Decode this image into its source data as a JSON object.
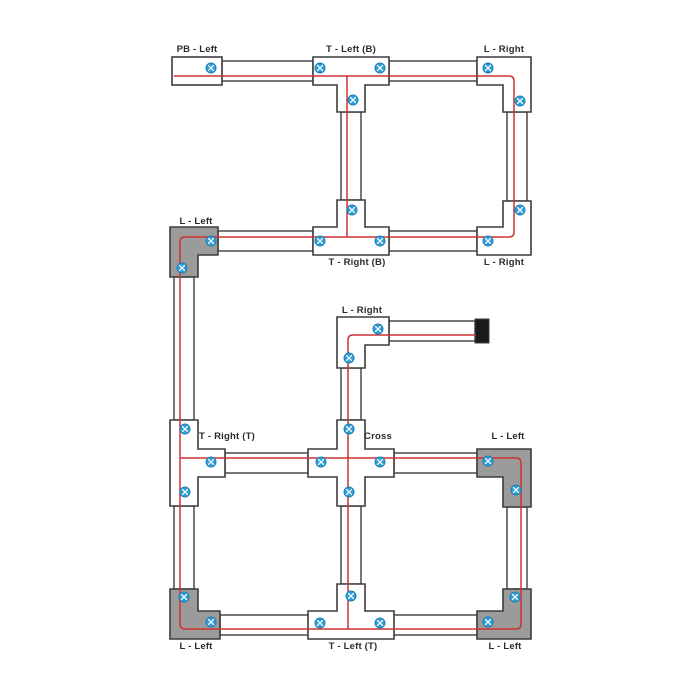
{
  "diagram": {
    "labels": {
      "pb_left": "PB - Left",
      "t_left_b": "T - Left (B)",
      "l_right_top": "L - Right",
      "l_left_mid": "L - Left",
      "t_right_b": "T - Right (B)",
      "l_right_mid": "L - Right",
      "l_right_feed": "L - Right",
      "t_right_t": "T - Right (T)",
      "cross": "Cross",
      "l_left_right": "L - Left",
      "l_left_bottom_left": "L - Left",
      "t_left_t": "T - Left (T)",
      "l_left_bottom_right": "L - Left"
    },
    "colors": {
      "background": "#ffffff",
      "track_outline": "#3d3d3d",
      "conductor_red": "#cc3333",
      "screw_blue": "#2e9fd8",
      "connector_gray": "#9b9b9b",
      "end_cap_black": "#1a1a1a",
      "label_color": "#2b2b2b"
    },
    "icons": {
      "screw": "screw-terminal-icon",
      "end_cap": "track-end-cap"
    }
  }
}
